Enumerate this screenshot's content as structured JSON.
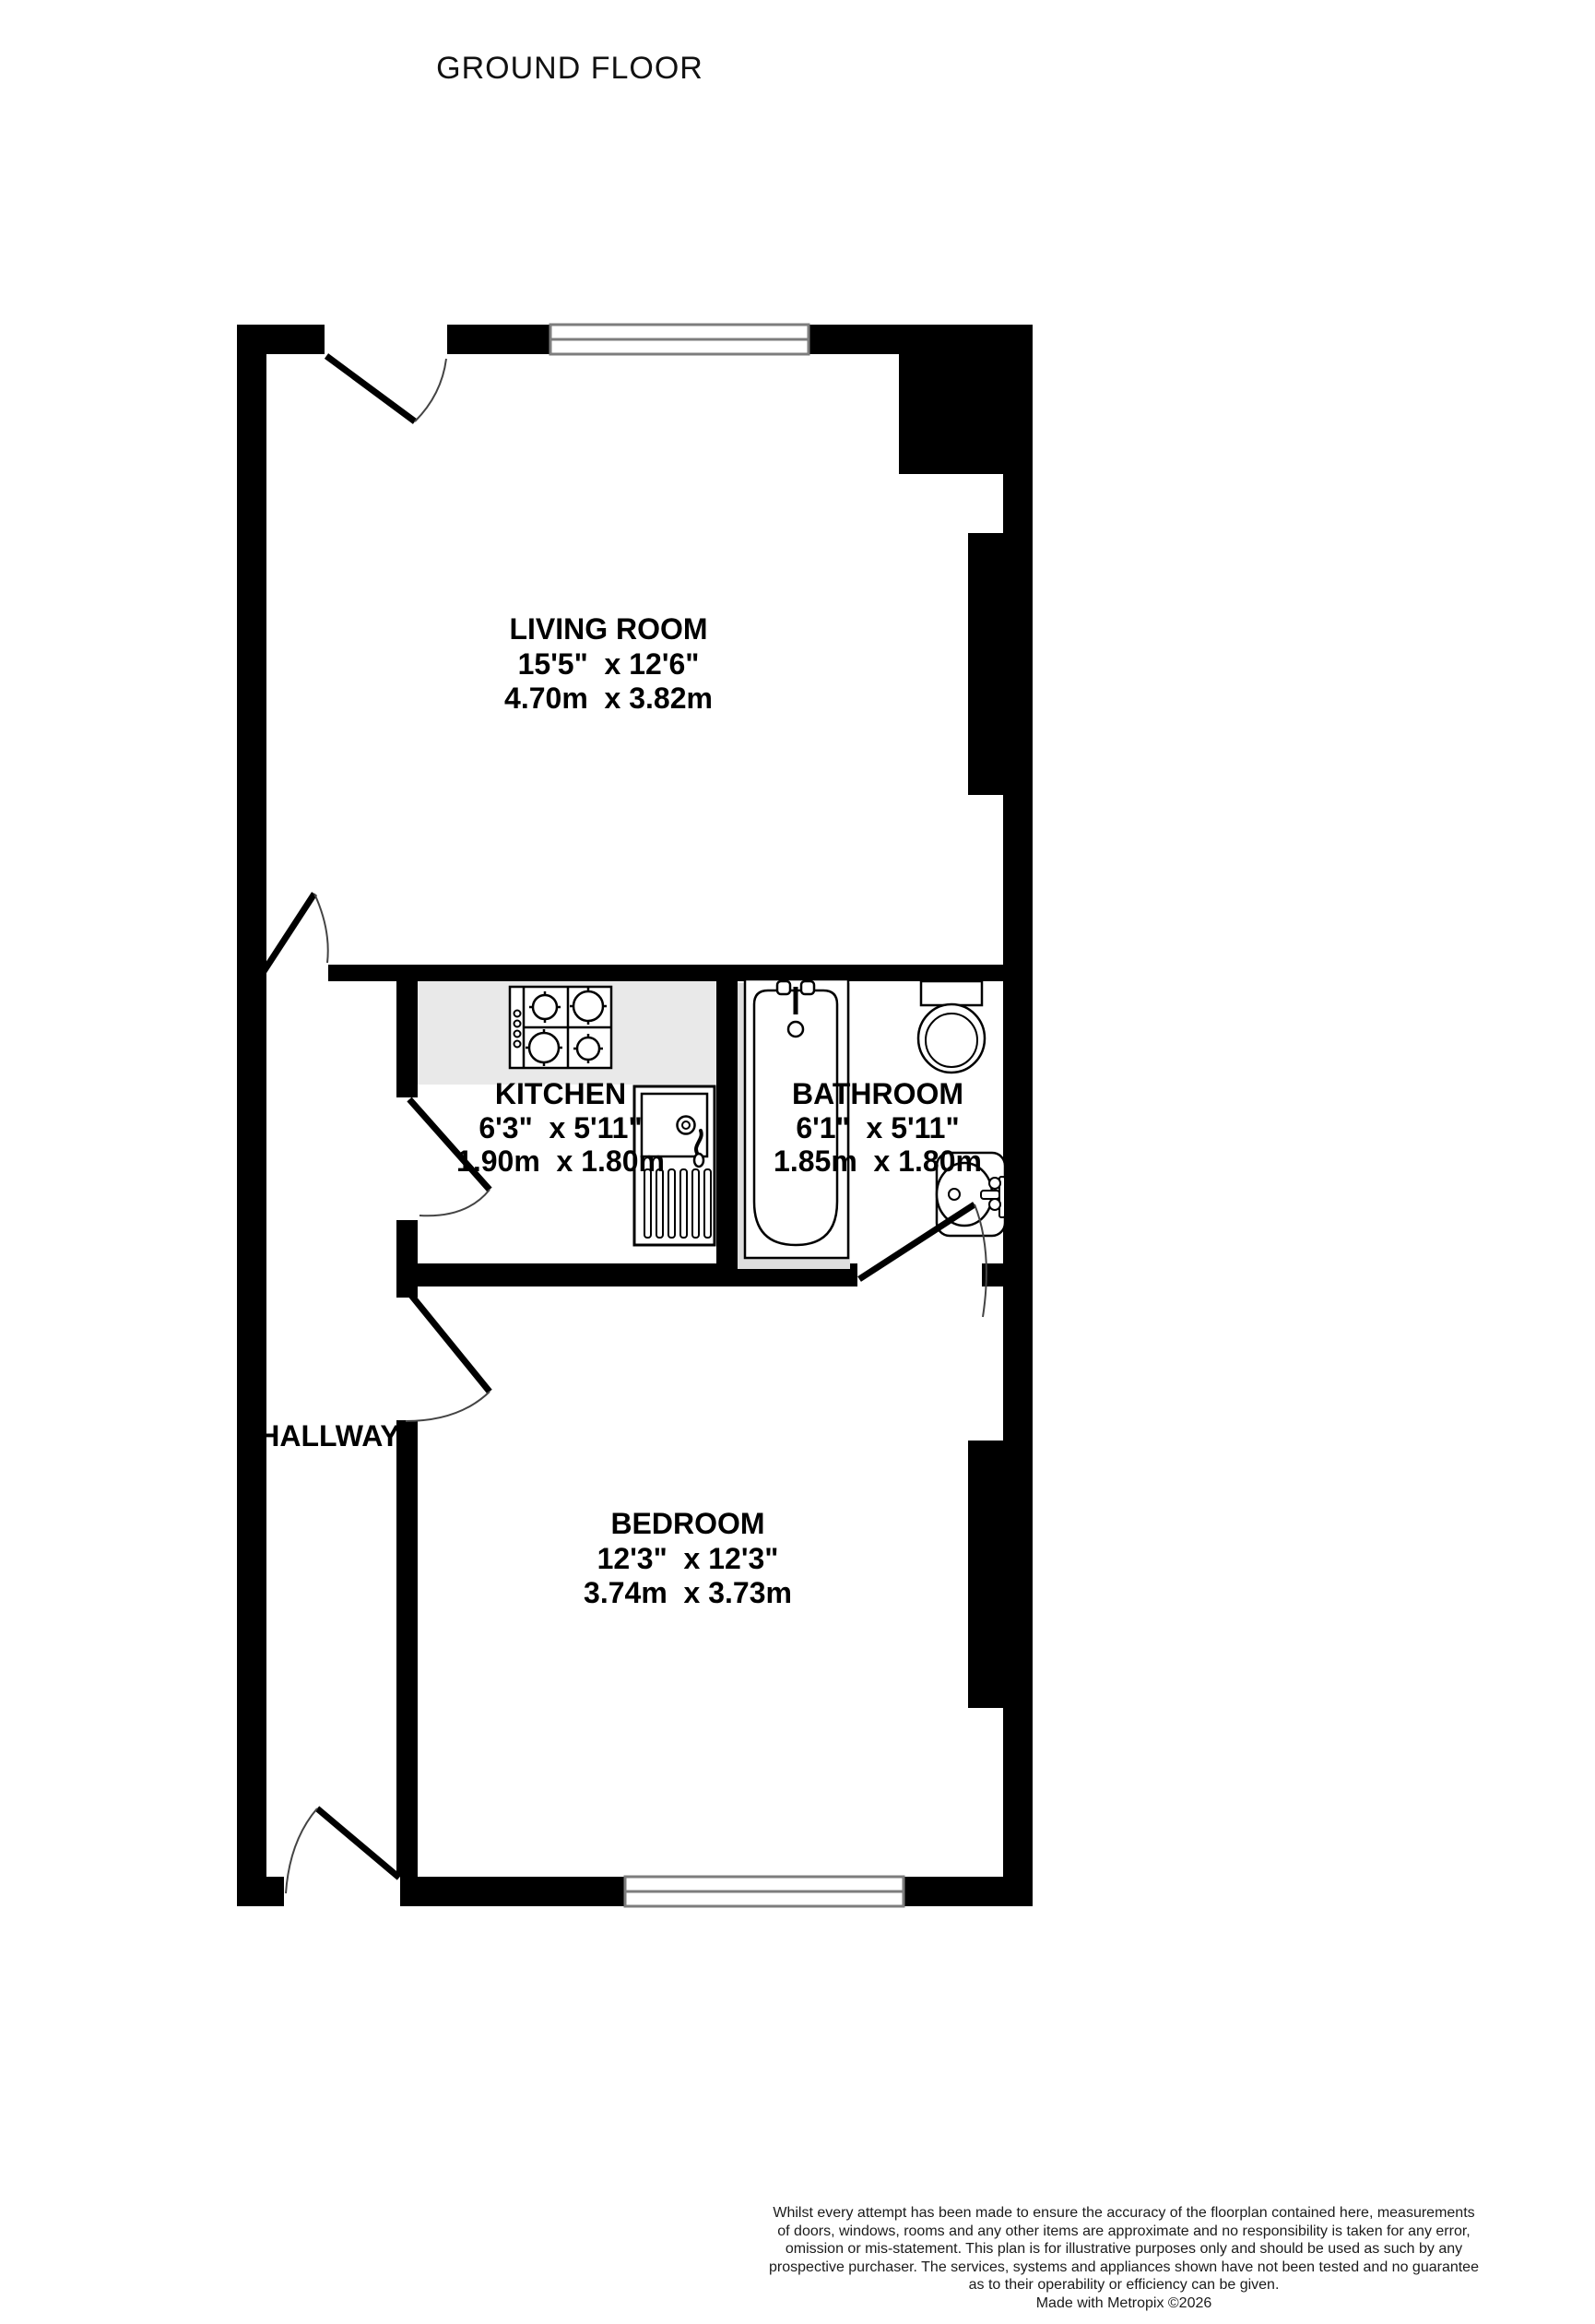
{
  "title": "GROUND FLOOR",
  "rooms": {
    "living_room": {
      "name": "LIVING ROOM",
      "imperial": "15'5\"  x 12'6\"",
      "metric": "4.70m  x 3.82m"
    },
    "kitchen": {
      "name": "KITCHEN",
      "imperial": "6'3\"  x 5'11\"",
      "metric": "1.90m  x 1.80m"
    },
    "bathroom": {
      "name": "BATHROOM",
      "imperial": "6'1\"  x 5'11\"",
      "metric": "1.85m  x 1.80m"
    },
    "bedroom": {
      "name": "BEDROOM",
      "imperial": "12'3\"  x 12'3\"",
      "metric": "3.74m  x 3.73m"
    },
    "hallway": {
      "name": "HALLWAY"
    }
  },
  "fixtures": [
    "hob",
    "sink-unit",
    "bathtub",
    "toilet",
    "wash-basin"
  ],
  "colors": {
    "wall": "#000000",
    "window_frame": "#7d7d7d",
    "counter": "#e9e9e9",
    "bath_shadow": "#dedede",
    "fixture_outline": "#000000",
    "label_text": "#000000",
    "disclaimer_text": "#1b1b1b"
  },
  "disclaimer": {
    "lines": [
      "Whilst every attempt has been made to ensure the accuracy of the floorplan contained here, measurements",
      "of doors, windows, rooms and any other items are approximate and no responsibility is taken for any error,",
      "omission or mis-statement. This plan is for illustrative purposes only and should be used as such by any",
      "prospective purchaser. The services, systems and appliances shown have not been tested and no guarantee",
      "as to their operability or efficiency can be given.",
      "Made with Metropix ©2026"
    ]
  }
}
